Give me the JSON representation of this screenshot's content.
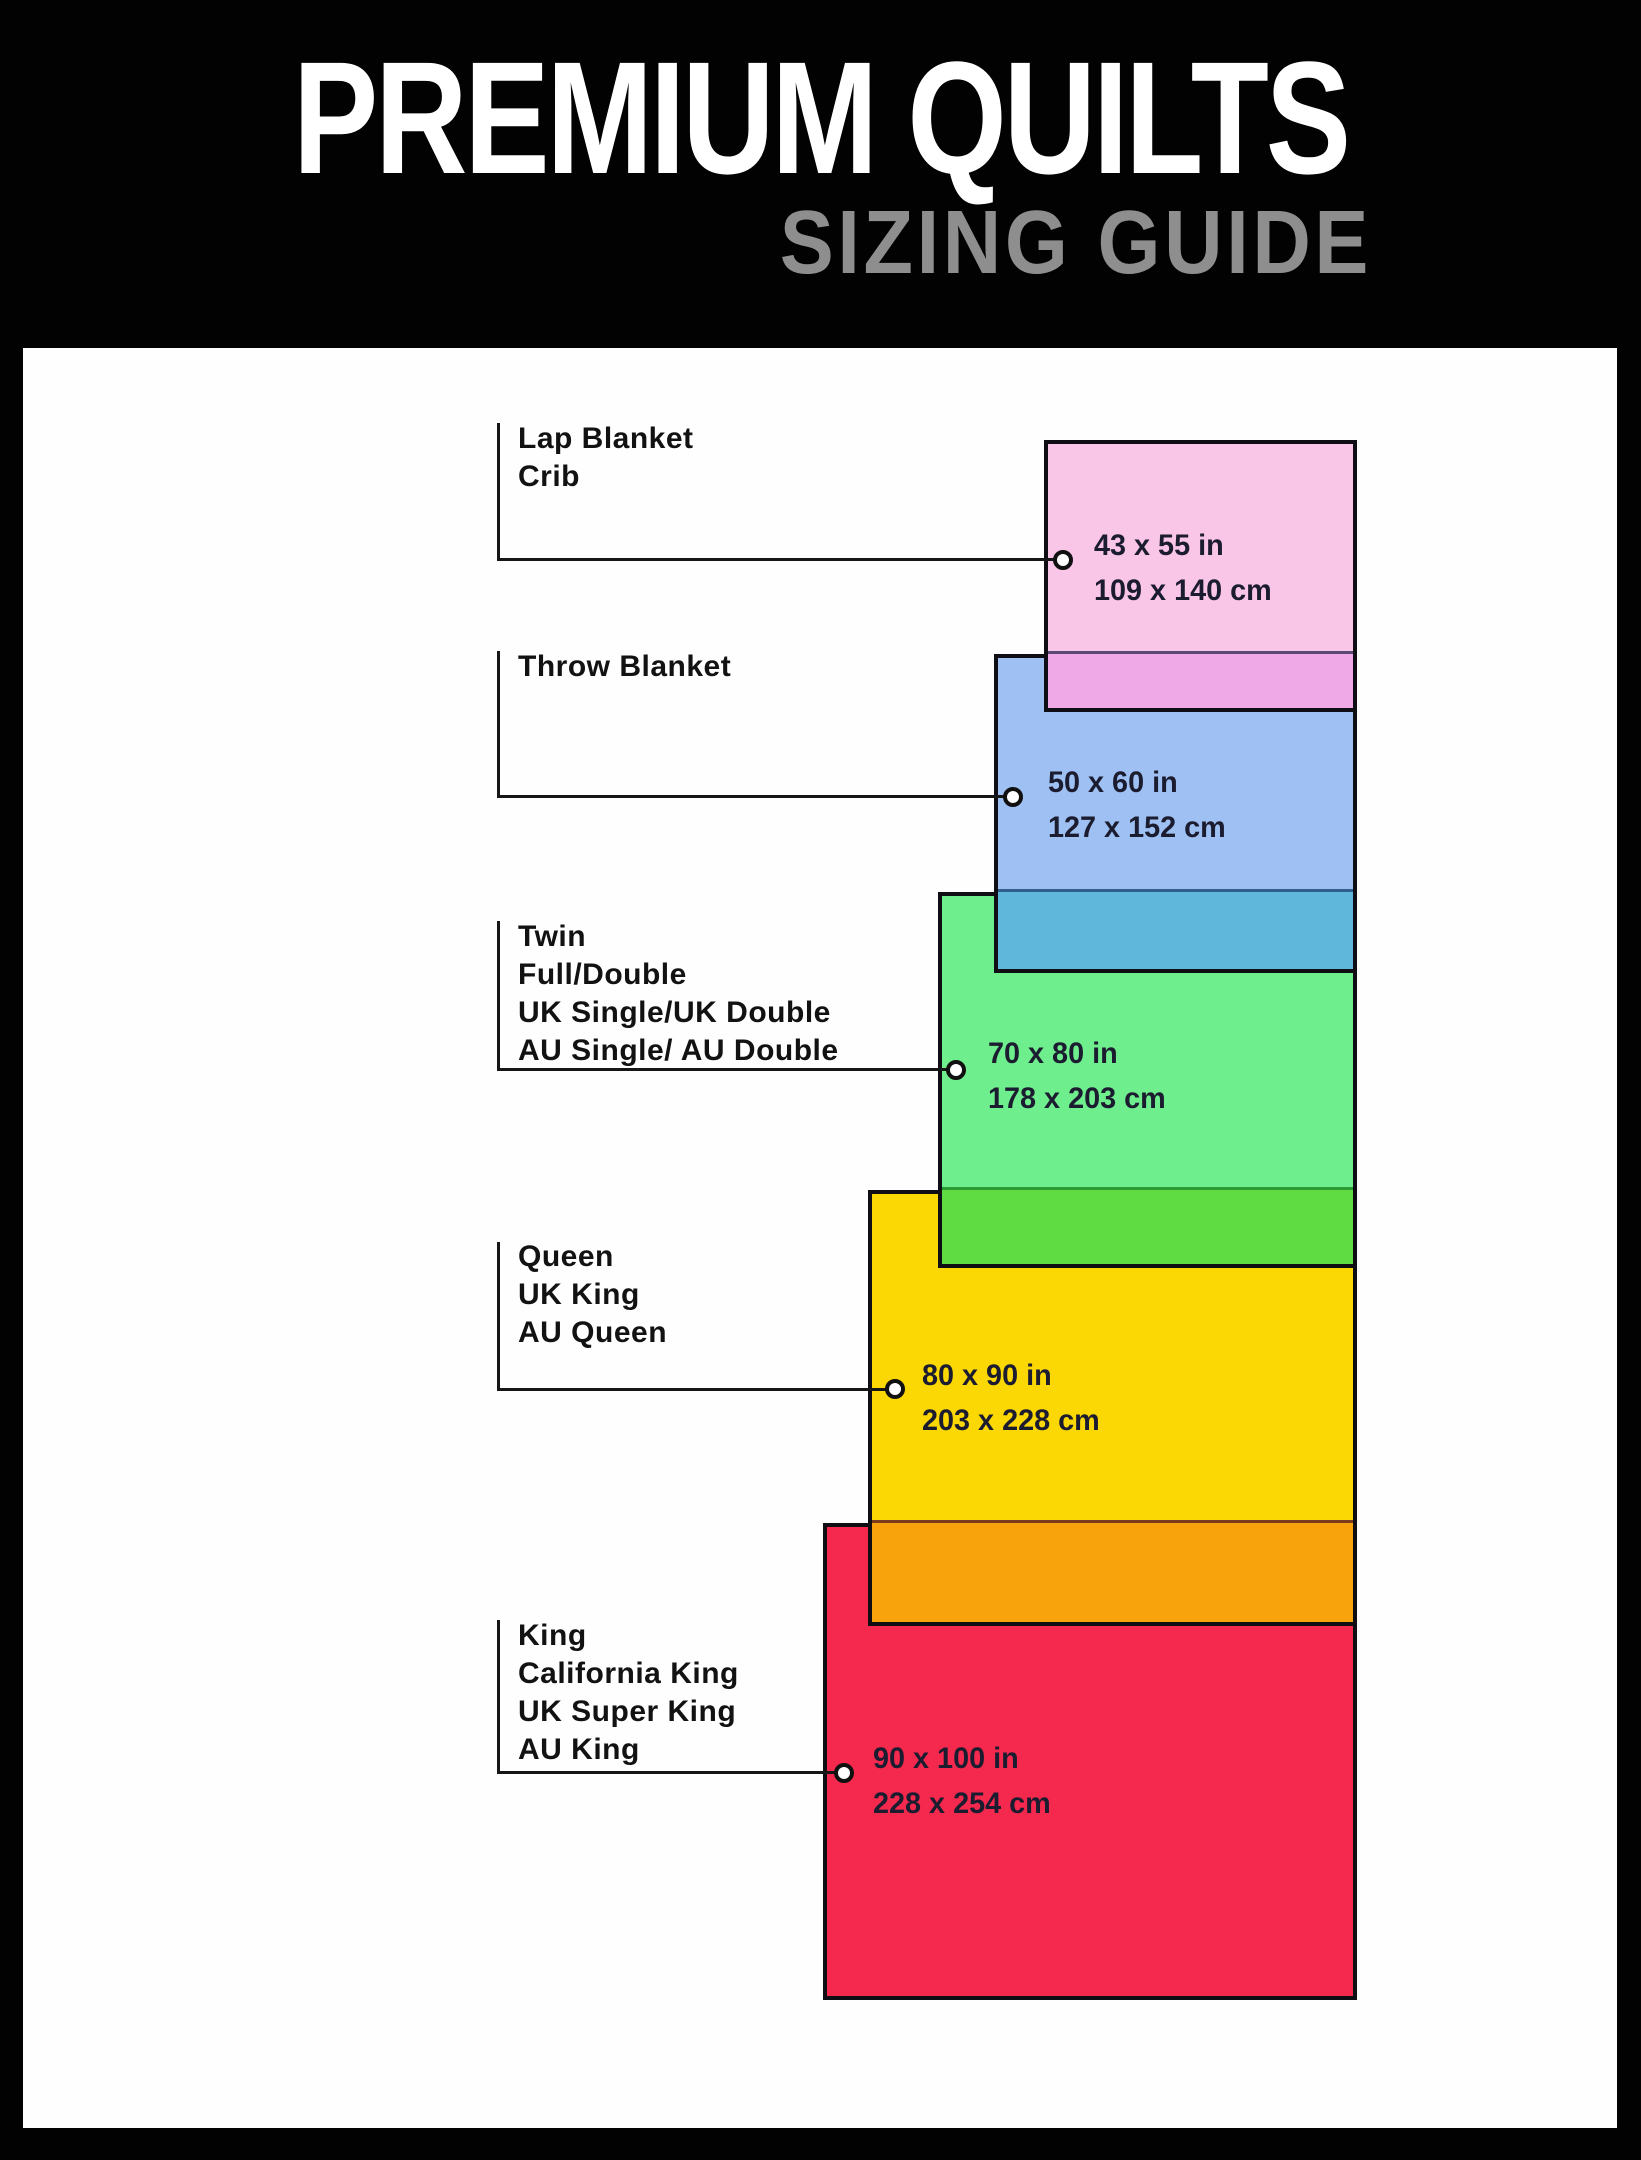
{
  "header": {
    "title": "PREMIUM QUILTS",
    "subtitle": "SIZING GUIDE",
    "background_color": "#020202",
    "title_color": "#ffffff",
    "subtitle_color": "#8e8e8e"
  },
  "panel_color": "#fefefe",
  "sizes": [
    {
      "name": "lap-crib",
      "labels": [
        "Lap Blanket",
        "Crib"
      ],
      "inches": "43 x 55 in",
      "centimeters": "109 x 140 cm",
      "fill": "#fac6e8",
      "overlap_fill": "#efa9e6"
    },
    {
      "name": "throw",
      "labels": [
        "Throw Blanket"
      ],
      "inches": "50 x 60 in",
      "centimeters": "127 x 152 cm",
      "fill": "#9ec0f2",
      "overlap_fill": "#5fb8db"
    },
    {
      "name": "twin-full-double",
      "labels": [
        "Twin",
        "Full/Double",
        "UK Single/UK Double",
        "AU Single/ AU Double"
      ],
      "inches": "70 x 80 in",
      "centimeters": "178 x 203 cm",
      "fill": "#6fee8d",
      "overlap_fill": "#5edc41"
    },
    {
      "name": "queen",
      "labels": [
        "Queen",
        "UK King",
        "AU Queen"
      ],
      "inches": "80 x 90 in",
      "centimeters": "203 x 228 cm",
      "fill": "#fbd804",
      "overlap_fill": "#f8a30c"
    },
    {
      "name": "king",
      "labels": [
        "King",
        "California King",
        "UK Super King",
        "AU King"
      ],
      "inches": "90 x 100 in",
      "centimeters": "228 x 254 cm",
      "fill": "#f4294d",
      "overlap_fill": ""
    }
  ]
}
